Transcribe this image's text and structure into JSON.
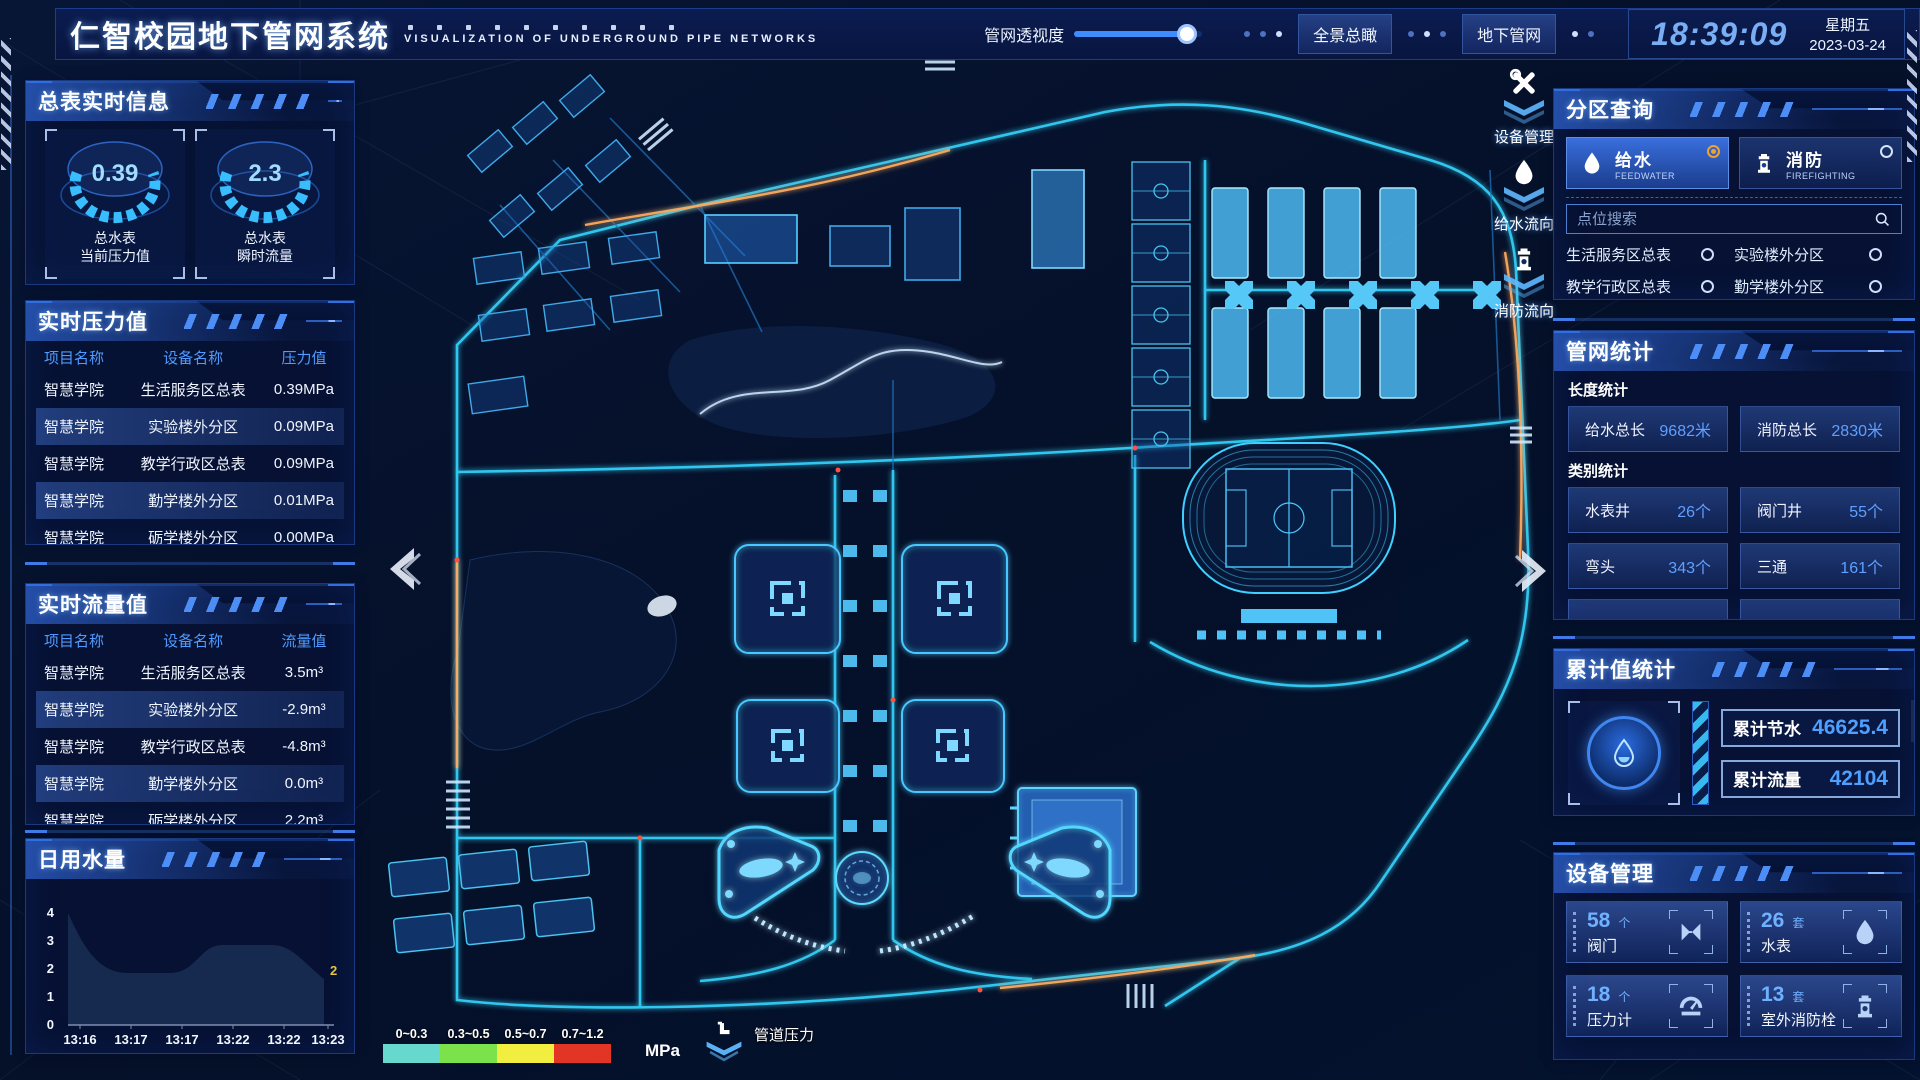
{
  "header": {
    "title": "仁智校园地下管网系统",
    "subtitle": "VISUALIZATION OF UNDERGROUND PIPE NETWORKS",
    "transparency_label": "管网透视度",
    "transparency_percent": 88,
    "buttons": {
      "overview": "全景总瞰",
      "underground": "地下管网"
    },
    "clock": {
      "time": "18:39:09",
      "weekday": "星期五",
      "date": "2023-03-24"
    }
  },
  "theme": {
    "accent_blue": "#3f8cff",
    "glow_cyan": "#35d6ff",
    "value_blue": "#4f9bff",
    "selected_orange": "#f0a22c",
    "panel_bg": "#071234"
  },
  "left": {
    "meter_panel": {
      "title": "总表实时信息",
      "gauges": [
        {
          "value": "0.39",
          "label1": "总水表",
          "label2": "当前压力值"
        },
        {
          "value": "2.3",
          "label1": "总水表",
          "label2": "瞬时流量"
        }
      ]
    },
    "pressure_panel": {
      "title": "实时压力值",
      "headers": [
        "项目名称",
        "设备名称",
        "压力值"
      ],
      "rows": [
        {
          "project": "智慧学院",
          "device": "生活服务区总表",
          "value": "0.39MPa"
        },
        {
          "project": "智慧学院",
          "device": "实验楼外分区",
          "value": "0.09MPa"
        },
        {
          "project": "智慧学院",
          "device": "教学行政区总表",
          "value": "0.09MPa"
        },
        {
          "project": "智慧学院",
          "device": "勤学楼外分区",
          "value": "0.01MPa"
        },
        {
          "project": "智慧学院",
          "device": "砺学楼外分区",
          "value": "0.00MPa"
        }
      ]
    },
    "flow_panel": {
      "title": "实时流量值",
      "headers": [
        "项目名称",
        "设备名称",
        "流量值"
      ],
      "rows": [
        {
          "project": "智慧学院",
          "device": "生活服务区总表",
          "value": "3.5m³"
        },
        {
          "project": "智慧学院",
          "device": "实验楼外分区",
          "value": "-2.9m³"
        },
        {
          "project": "智慧学院",
          "device": "教学行政区总表",
          "value": "-4.8m³"
        },
        {
          "project": "智慧学院",
          "device": "勤学楼外分区",
          "value": "0.0m³"
        },
        {
          "project": "智慧学院",
          "device": "砺学楼外分区",
          "value": "2.2m³"
        }
      ]
    },
    "daily_panel": {
      "title": "日用水量"
    }
  },
  "chart_data": {
    "type": "area",
    "title": "日用水量",
    "x": [
      "13:16",
      "13:17",
      "13:17",
      "13:22",
      "13:22",
      "13:23"
    ],
    "values": [
      4,
      2.2,
      2.2,
      3,
      3,
      2
    ],
    "y_ticks": [
      "4",
      "3",
      "2",
      "1",
      "0"
    ],
    "ylim": [
      0,
      4
    ],
    "end_label": "2",
    "legend_position": "none",
    "grid": false
  },
  "right": {
    "zone_panel": {
      "title": "分区查询",
      "feedwater": {
        "label": "给水",
        "sub": "FEEDWATER",
        "selected": true
      },
      "firefighting": {
        "label": "消防",
        "sub": "FIREFIGHTING",
        "selected": false
      },
      "search_placeholder": "点位搜索",
      "items": [
        "生活服务区总表",
        "实验楼外分区",
        "教学行政区总表",
        "勤学楼外分区",
        "砺学楼外分区",
        "宿舍区泵房"
      ]
    },
    "network_panel": {
      "title": "管网统计",
      "length_label": "长度统计",
      "length_stats": [
        {
          "label": "给水总长",
          "value": "9682米"
        },
        {
          "label": "消防总长",
          "value": "2830米"
        }
      ],
      "category_label": "类别统计",
      "category_stats": [
        {
          "label": "水表井",
          "value": "26个"
        },
        {
          "label": "阀门井",
          "value": "55个"
        },
        {
          "label": "弯头",
          "value": "343个"
        },
        {
          "label": "三通",
          "value": "161个"
        }
      ]
    },
    "cumulative_panel": {
      "title": "累计值统计",
      "stats": [
        {
          "label": "累计节水",
          "value": "46625.4"
        },
        {
          "label": "累计流量",
          "value": "42104"
        }
      ]
    },
    "device_panel": {
      "title": "设备管理",
      "devices": [
        {
          "count": "58",
          "unit": "个",
          "name": "阀门"
        },
        {
          "count": "26",
          "unit": "套",
          "name": "水表"
        },
        {
          "count": "18",
          "unit": "个",
          "name": "压力计"
        },
        {
          "count": "13",
          "unit": "套",
          "name": "室外消防栓"
        }
      ]
    }
  },
  "map": {
    "overlay_icons": [
      {
        "label": "设备管理"
      },
      {
        "label": "给水流向"
      },
      {
        "label": "消防流向"
      }
    ],
    "legend": {
      "ranges": [
        "0~0.3",
        "0.3~0.5",
        "0.5~0.7",
        "0.7~1.2"
      ],
      "colors": [
        "#66d8ce",
        "#7ce24c",
        "#f2ee40",
        "#e23525"
      ],
      "unit": "MPa",
      "pipe_pressure_label": "管道压力"
    }
  }
}
